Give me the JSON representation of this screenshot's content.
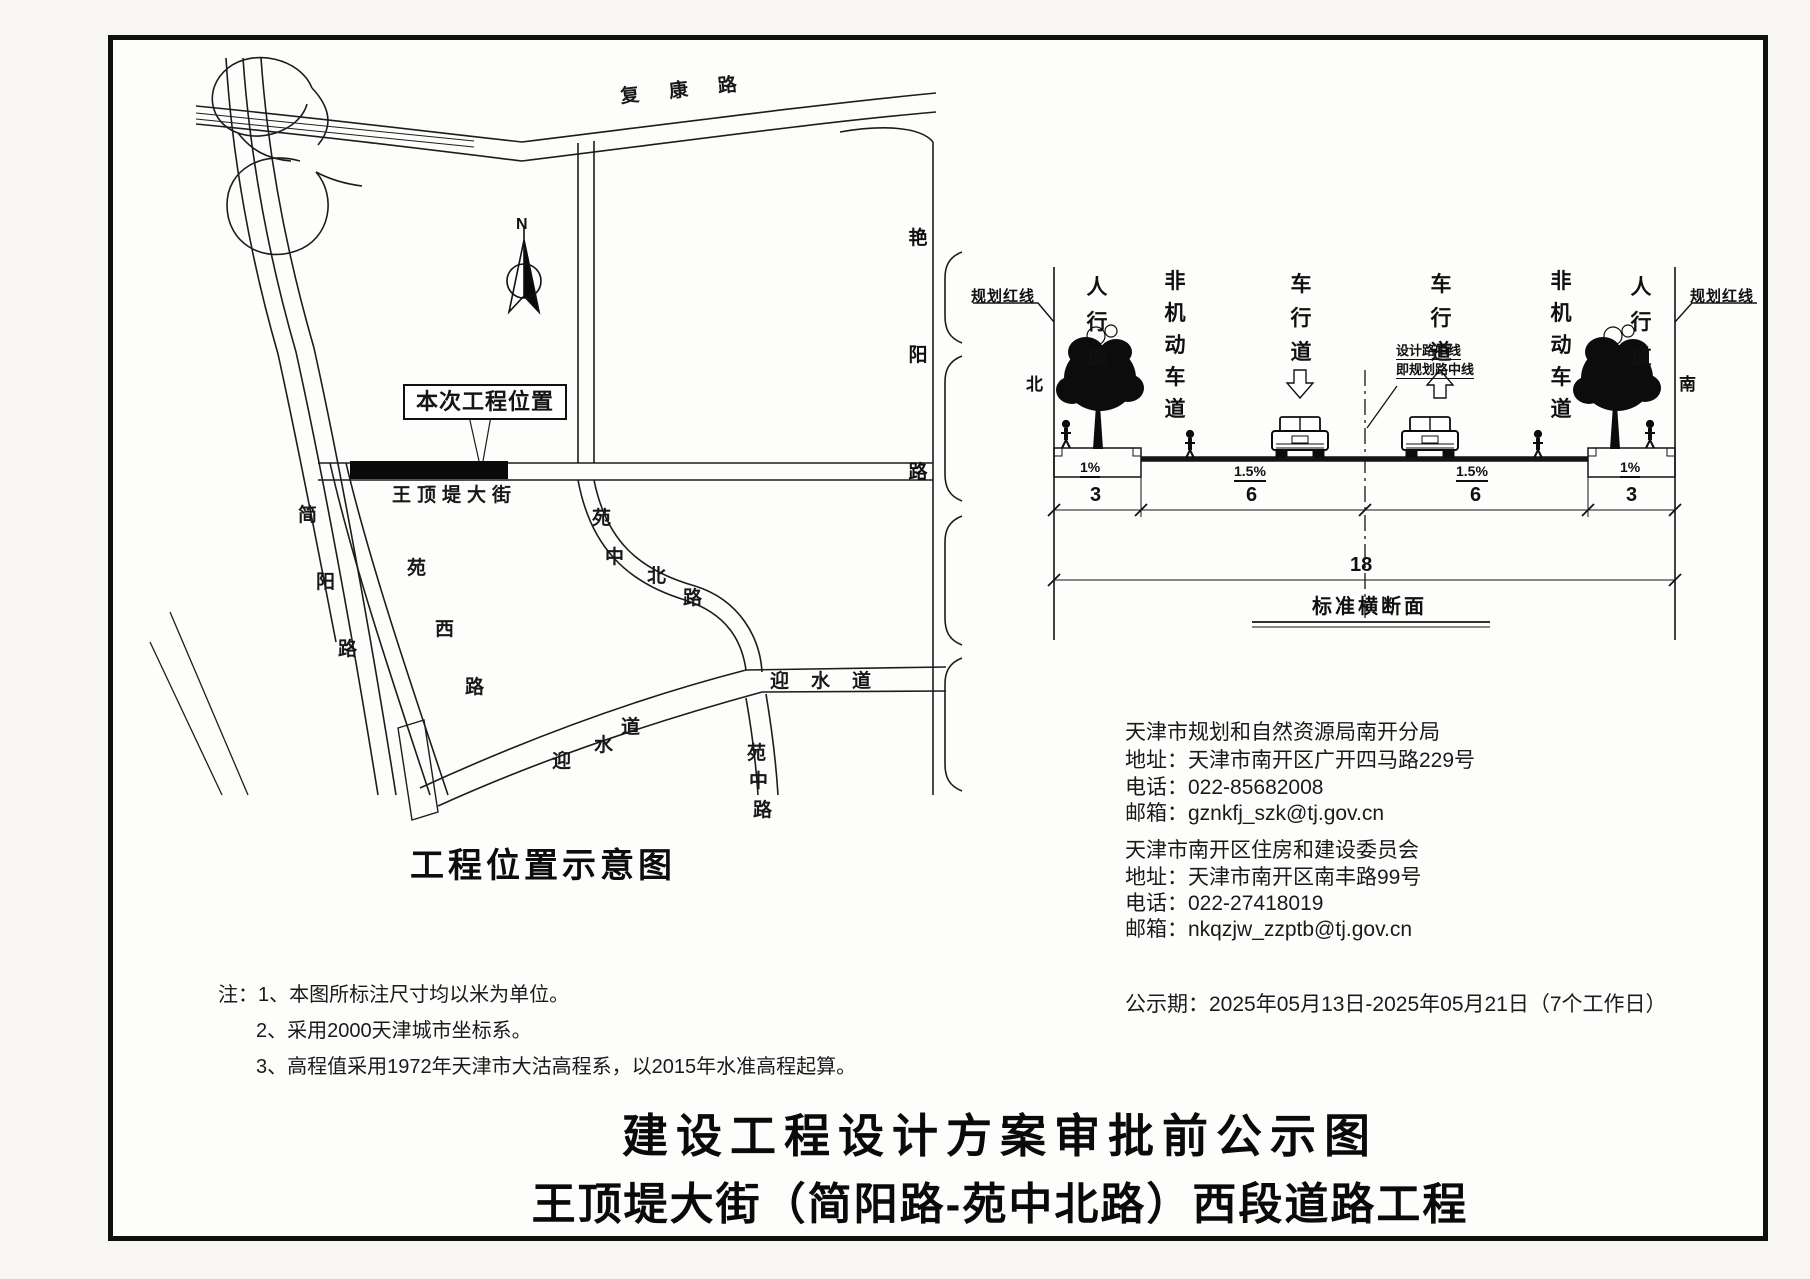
{
  "map": {
    "north_mark": "N",
    "project_label": "本次工程位置",
    "title": "工程位置示意图",
    "roads": {
      "fukang": "复康路",
      "yanyang": "艳阳路",
      "wangdingdi": "王顶堤大街",
      "jianyang": [
        "简",
        "阳",
        "路"
      ],
      "yuanxi": [
        "苑",
        "西",
        "路"
      ],
      "yuanzhongbei": [
        "苑",
        "中",
        "北",
        "路"
      ],
      "yingshui_diagonal": [
        "迎",
        "水",
        "道"
      ],
      "yingshui_horizontal": "迎水道",
      "yuanzhong": [
        "苑",
        "中",
        "路"
      ]
    }
  },
  "cross_section": {
    "red_line_left": "规划红线",
    "red_line_right": "规划红线",
    "north": "北",
    "south": "南",
    "lanes": {
      "sidewalk_left": "人行道",
      "nonmotor_left": "非机动车道",
      "vehicle_left": "车行道",
      "vehicle_right": "车行道",
      "nonmotor_right": "非机动车道",
      "sidewalk_right": "人行道"
    },
    "centerline_label_line1": "设计路中线",
    "centerline_label_line2": "即规划路中线",
    "slope_left_sidewalk": "1%",
    "slope_left_lane": "1.5%",
    "slope_right_lane": "1.5%",
    "slope_right_sidewalk": "1%",
    "dim_left_sidewalk": "3",
    "dim_left_lane": "6",
    "dim_right_lane": "6",
    "dim_right_sidewalk": "3",
    "dim_total": "18",
    "title": "标准横断面"
  },
  "contacts": [
    {
      "name": "天津市规划和自然资源局南开分局",
      "address": "地址：天津市南开区广开四马路229号",
      "phone": "电话：022-85682008",
      "email": "邮箱：gznkfj_szk@tj.gov.cn"
    },
    {
      "name": "天津市南开区住房和建设委员会",
      "address": "地址：天津市南开区南丰路99号",
      "phone": "电话：022-27418019",
      "email": "邮箱：nkqzjw_zzptb@tj.gov.cn"
    }
  ],
  "notice_period": "公示期：2025年05月13日-2025年05月21日（7个工作日）",
  "notes": [
    "注：1、本图所标注尺寸均以米为单位。",
    "2、采用2000天津城市坐标系。",
    "3、高程值采用1972年天津市大沽高程系，以2015年水准高程起算。"
  ],
  "main_title_line1": "建设工程设计方案审批前公示图",
  "main_title_line2": "王顶堤大街（简阳路-苑中北路）西段道路工程"
}
